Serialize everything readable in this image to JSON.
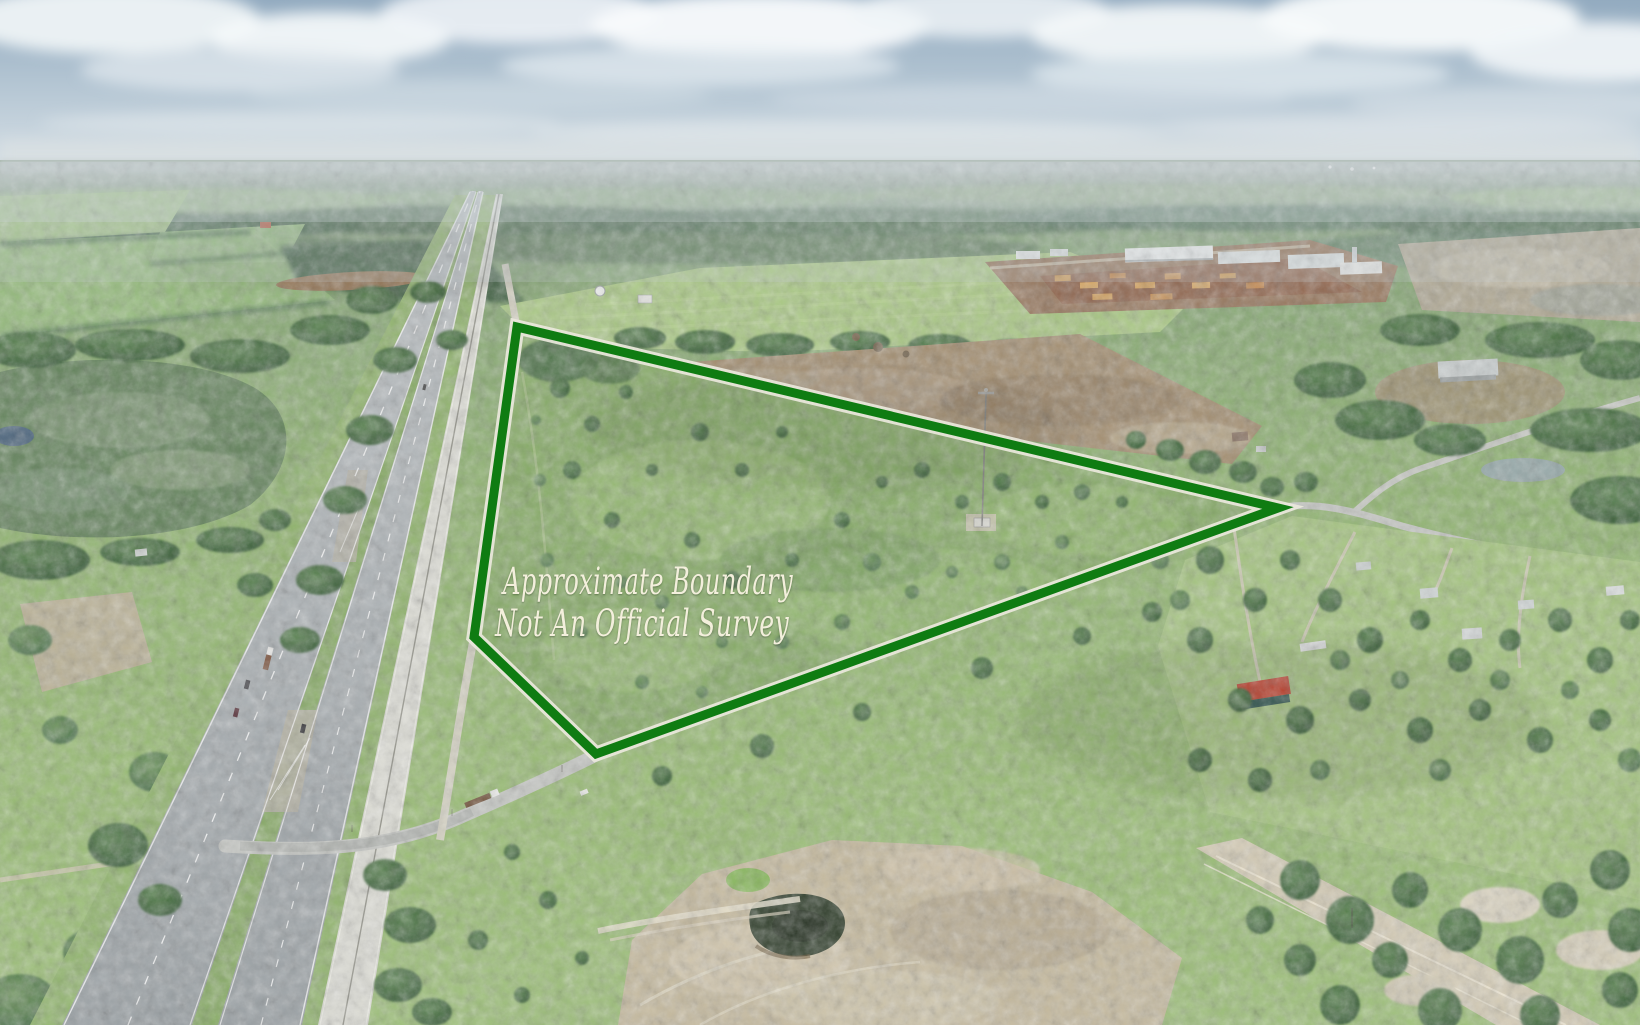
{
  "watermark": {
    "line1": "Approximate Boundary",
    "line2": "Not An Official Survey"
  },
  "boundary": {
    "stroke": "#0f7c12",
    "casing": "#eae8dc"
  },
  "palette": {
    "sky": "#a9bdcf",
    "cloud": "#f5f8fa",
    "haze": "#b9c6c6",
    "far_forest": "#4b6b51",
    "field": "#a9c982",
    "scrub": "#85ab64",
    "forest": "#3f6243",
    "cleared_dirt": "#a28c6d",
    "mill_yard": "#8d5f46",
    "lumber": "#cf9a55",
    "road_asphalt": "#a3aaae",
    "railroad": "#dfdfd7",
    "dirt_road": "#d0ccbc",
    "sand": "#c6ba9d",
    "red_roof": "#c33b26",
    "pond": "#47617a",
    "burn_pond": "#2b3a26"
  }
}
